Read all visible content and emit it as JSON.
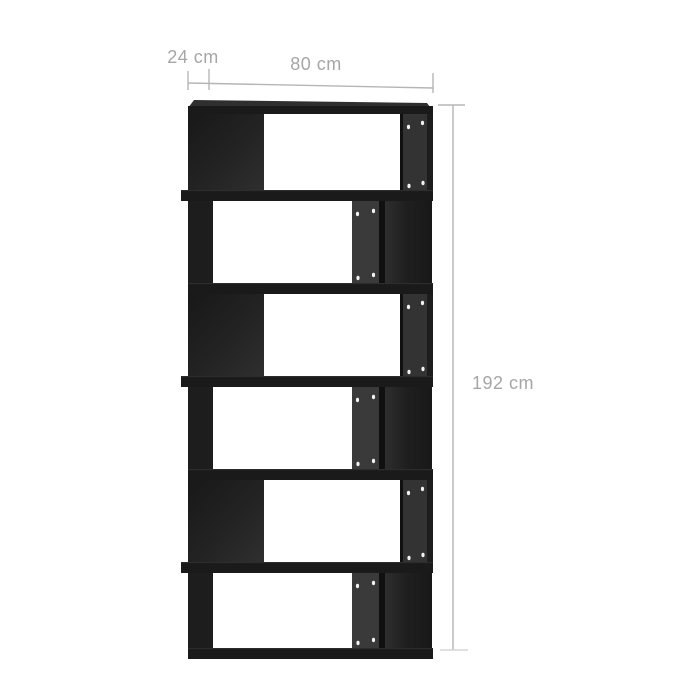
{
  "page": {
    "background_color": "#ffffff"
  },
  "product_image": {
    "description": "Black zigzag book cabinet / room divider with 6 offset open compartments, slight right-side perspective, shelf pin holes visible on inner panels",
    "tier_count": 6,
    "colors": {
      "front": "#1d1d1d",
      "board": "#1a1a1a",
      "board_highlight": "#2c2c2c",
      "edge_dark": "#101010",
      "top_surface": "#2f2f2f",
      "inner_panel_odd": "#333333",
      "inner_panel_even": "#3a3a3a",
      "interior_dark": "#161616",
      "interior_light": "#303030",
      "pin_hole": "#f2f2f2"
    }
  },
  "dimensions": {
    "depth_label": "24 cm",
    "width_label": "80 cm",
    "height_label": "192 cm"
  },
  "annotation": {
    "line_color": "#b5b5b5",
    "faint_line_color": "#d5d5d5",
    "text_color": "#a6a6a6"
  }
}
